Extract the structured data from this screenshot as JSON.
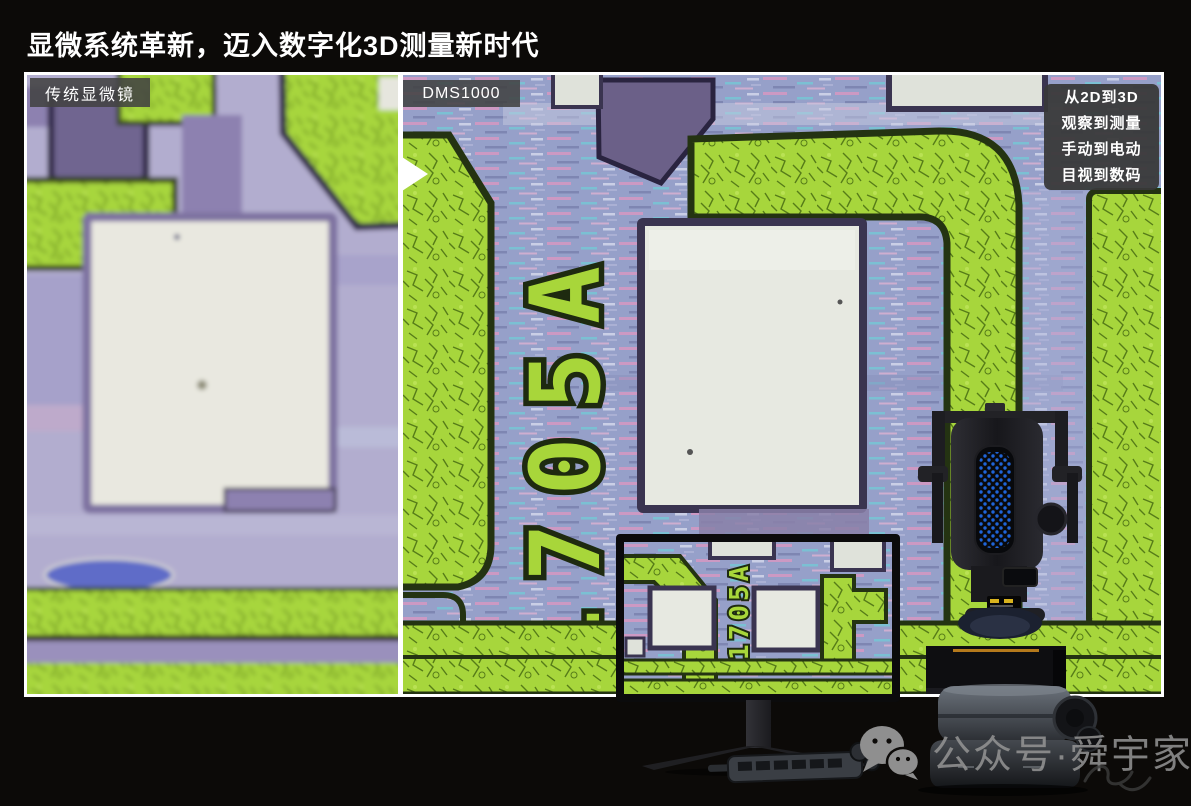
{
  "title": "显微系统革新，迈入数字化3D测量新时代",
  "comparison": {
    "left_label": "传统显微镜",
    "right_label": "DMS1000",
    "chip_marking": "1705A",
    "chip_marking_inset": "1705A"
  },
  "feature_box": {
    "lines": [
      "从2D到3D",
      "观察到测量",
      "手动到电动",
      "目视到数码"
    ]
  },
  "watermark": {
    "icon": "wechat-icon",
    "text": "公众号·舜宇家"
  },
  "colors": {
    "background": "#0c0a08",
    "pcb_green": "#a7d63c",
    "pcb_periwinkle": "#96a0c9",
    "pad_white": "#e8e9e1",
    "purple_trace": "#8d81b0",
    "led_blue": "#1f64d8",
    "frame_white": "#ffffff",
    "label_gray": "#424242"
  }
}
